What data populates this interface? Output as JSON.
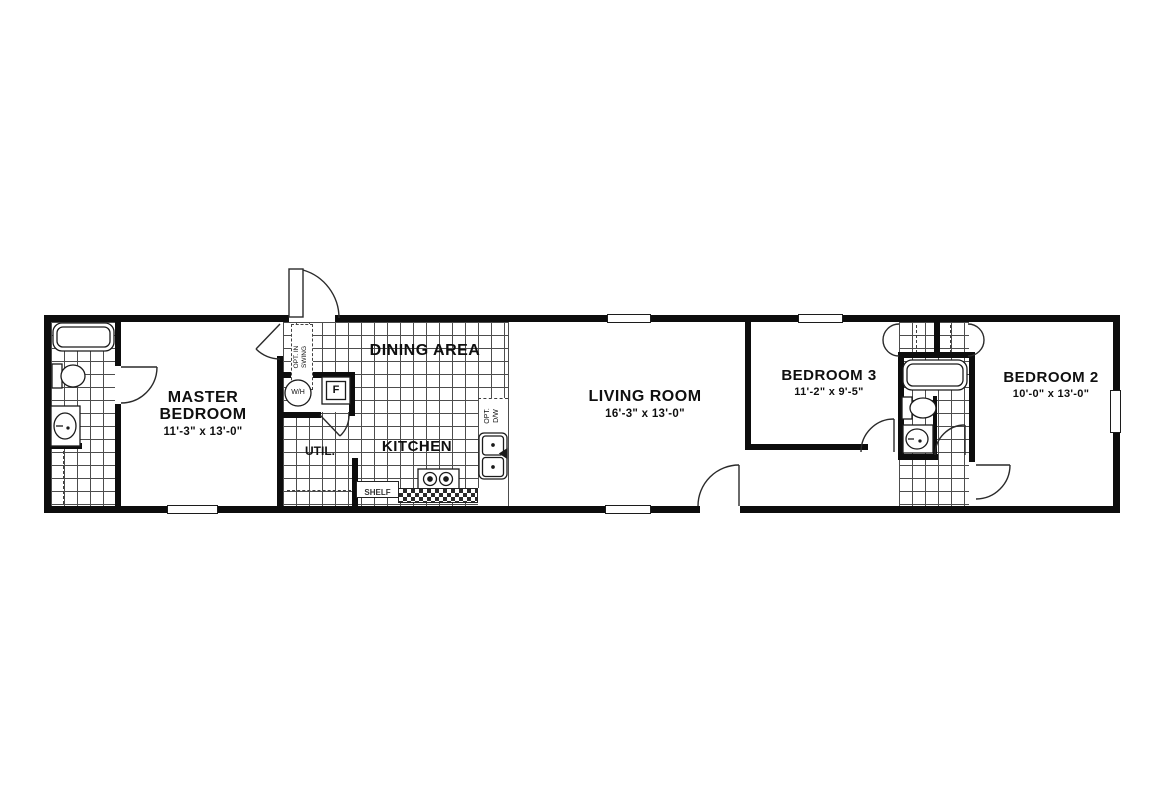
{
  "floorplan": {
    "rooms": {
      "master_bedroom": {
        "name": "MASTER BEDROOM",
        "dims": "11'-3\" x 13'-0\""
      },
      "dining": {
        "name": "DINING AREA"
      },
      "kitchen": {
        "name": "KITCHEN"
      },
      "util": {
        "name": "UTIL."
      },
      "living": {
        "name": "LIVING ROOM",
        "dims": "16'-3\" x 13'-0\""
      },
      "bedroom3": {
        "name": "BEDROOM 3",
        "dims": "11'-2\" x 9'-5\""
      },
      "bedroom2": {
        "name": "BEDROOM 2",
        "dims": "10'-0\" x 13'-0\""
      }
    },
    "annotations": {
      "water_heater": "W/H",
      "furnace": "F",
      "shelf": "SHELF",
      "optional_dishwasher": "OPT. D/W",
      "optional_inswing": "OPT. IN SWING"
    },
    "colors": {
      "wall": "#0d0d0d",
      "floor": "#ffffff",
      "grid": "#4d4d4d"
    }
  }
}
